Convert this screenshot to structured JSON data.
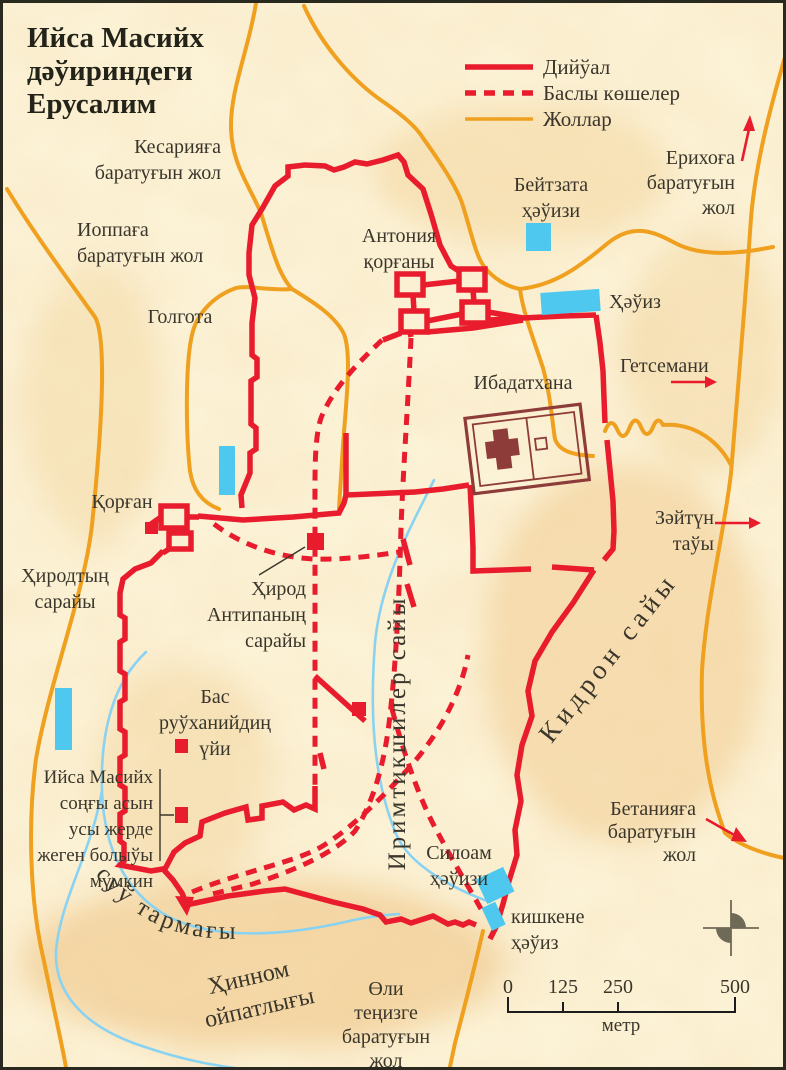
{
  "title": {
    "lines": [
      "Ийса Масийх",
      "дәўириндеги",
      "Ерусалим"
    ]
  },
  "legend": {
    "items": [
      {
        "label": "Дийўал",
        "type": "wall-solid-red"
      },
      {
        "label": "Баслы көшелер",
        "type": "street-dashed-red"
      },
      {
        "label": "Жоллар",
        "type": "road-orange"
      }
    ]
  },
  "colors": {
    "background": "#fcf3d7",
    "wall_red": "#e81c2d",
    "road_orange": "#f0a01f",
    "pool_blue": "#4fc8f0",
    "stream_blue": "#8ad2f2",
    "temple_maroon": "#8e3c39",
    "text_ink": "#3a362b",
    "compass_gray": "#6f6957",
    "scale_black": "#1c1c1c",
    "terrain_shade": "#edbd77"
  },
  "water_channel_label": "суў тармағы",
  "scale_bar": {
    "ticks": [
      "0",
      "125",
      "250",
      "500"
    ],
    "unit": "метр"
  },
  "map_labels": [
    {
      "id": "road-to-caesarea-label",
      "x": 218,
      "y": 150,
      "anchor": "end",
      "lines": [
        "Кесарияға",
        "баратуғын жол"
      ]
    },
    {
      "id": "road-to-joppa-label",
      "x": 74,
      "y": 233,
      "anchor": "start",
      "lines": [
        "Иоппаға",
        "баратуғын жол"
      ]
    },
    {
      "id": "golgotha-label",
      "x": 177,
      "y": 320,
      "anchor": "middle",
      "lines": [
        "Голгота"
      ]
    },
    {
      "id": "antonia-fortress-label",
      "x": 396,
      "y": 239,
      "anchor": "middle",
      "lines": [
        "Антония",
        "қорғаны"
      ]
    },
    {
      "id": "bethzatha-pool-label",
      "x": 548,
      "y": 188,
      "anchor": "middle",
      "lines": [
        "Бейтзата",
        "ҳәўизи"
      ]
    },
    {
      "id": "jericho-road-label",
      "x": 732,
      "y": 161,
      "anchor": "end",
      "lh": 25,
      "lines": [
        "Ерихоға",
        "баратуғын",
        "жол"
      ]
    },
    {
      "id": "pool-label",
      "x": 606,
      "y": 305,
      "anchor": "start",
      "lines": [
        "Ҳәўиз"
      ]
    },
    {
      "id": "temple-label",
      "x": 520,
      "y": 386,
      "anchor": "middle",
      "lines": [
        "Ибадатхана"
      ]
    },
    {
      "id": "gethsemane-label",
      "x": 617,
      "y": 369,
      "anchor": "start",
      "lines": [
        "Гетсемани"
      ]
    },
    {
      "id": "mount-of-olives-label",
      "x": 711,
      "y": 521,
      "anchor": "end",
      "lines": [
        "Зәйтүн",
        "таўы"
      ]
    },
    {
      "id": "kidron-valley-label",
      "x": 612,
      "y": 660,
      "anchor": "middle",
      "rotate": -52,
      "size": 27,
      "ls": 5,
      "lines": [
        "Кидрон сайы"
      ]
    },
    {
      "id": "qorgan-label",
      "x": 119,
      "y": 505,
      "anchor": "middle",
      "lines": [
        "Қорған"
      ]
    },
    {
      "id": "herod-palace-label",
      "x": 62,
      "y": 579,
      "anchor": "middle",
      "lines": [
        "Ҳиродтың",
        "сарайы"
      ]
    },
    {
      "id": "herod-antipas-label",
      "x": 303,
      "y": 592,
      "anchor": "end",
      "lines": [
        "Ҳирод",
        "Антипаның",
        "сарайы"
      ]
    },
    {
      "id": "high-priest-house-label",
      "x": 212,
      "y": 700,
      "anchor": "middle",
      "lines": [
        "Бас",
        "руўханийдиң",
        "үйи"
      ]
    },
    {
      "id": "last-supper-label",
      "x": 150,
      "y": 780,
      "anchor": "end",
      "size": 19,
      "lines": [
        "Ийса Масийх",
        "соңғы асын",
        "усы жерде",
        "жеген болыўы",
        "мүмкин"
      ]
    },
    {
      "id": "siloam-pool-label",
      "x": 456,
      "y": 856,
      "anchor": "middle",
      "lines": [
        "Силоам",
        "ҳәўизи"
      ]
    },
    {
      "id": "small-pool-label",
      "x": 508,
      "y": 920,
      "anchor": "start",
      "lines": [
        "кишкене",
        "ҳәўиз"
      ]
    },
    {
      "id": "bethany-road-label",
      "x": 693,
      "y": 812,
      "anchor": "end",
      "lh": 23,
      "lines": [
        "Бетанияға",
        "баратуғын",
        "жол"
      ]
    },
    {
      "id": "dead-sea-road-label",
      "x": 383,
      "y": 992,
      "anchor": "middle",
      "lh": 24,
      "lines": [
        "Өли",
        "теңизге",
        "баратуғын",
        "жол"
      ]
    },
    {
      "id": "hinnom-valley-label-1",
      "x": 247,
      "y": 982,
      "anchor": "middle",
      "rotate": -13,
      "size": 24,
      "lines": [
        "Ҳинном"
      ]
    },
    {
      "id": "hinnom-valley-label-2",
      "x": 258,
      "y": 1012,
      "anchor": "middle",
      "rotate": -13,
      "size": 24,
      "lines": [
        "ойпатлығы"
      ]
    },
    {
      "id": "cheesemakers-valley-label",
      "x": 402,
      "y": 730,
      "anchor": "middle",
      "rotate": -90,
      "size": 25,
      "ls": 3,
      "lines": [
        "Иримтикшилер сайы"
      ]
    }
  ]
}
